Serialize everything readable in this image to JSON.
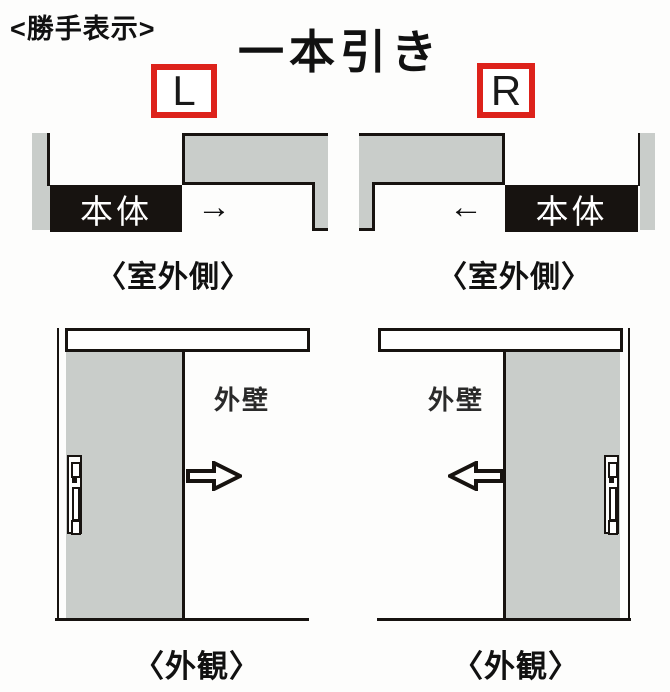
{
  "colors": {
    "accent_red": "#dd221b",
    "panel_gray": "#c9cdca",
    "body_black": "#171310"
  },
  "header": {
    "handedness_label": "<勝手表示>",
    "title": "一本引き"
  },
  "plan_left": {
    "letter": "L",
    "body_label": "本体",
    "arrow": "→",
    "caption": "〈室外側〉"
  },
  "plan_right": {
    "letter": "R",
    "body_label": "本体",
    "arrow": "←",
    "caption": "〈室外側〉"
  },
  "elevation_left": {
    "wall_label": "外壁",
    "caption": "〈外観〉"
  },
  "elevation_right": {
    "wall_label": "外壁",
    "caption": "〈外観〉"
  }
}
